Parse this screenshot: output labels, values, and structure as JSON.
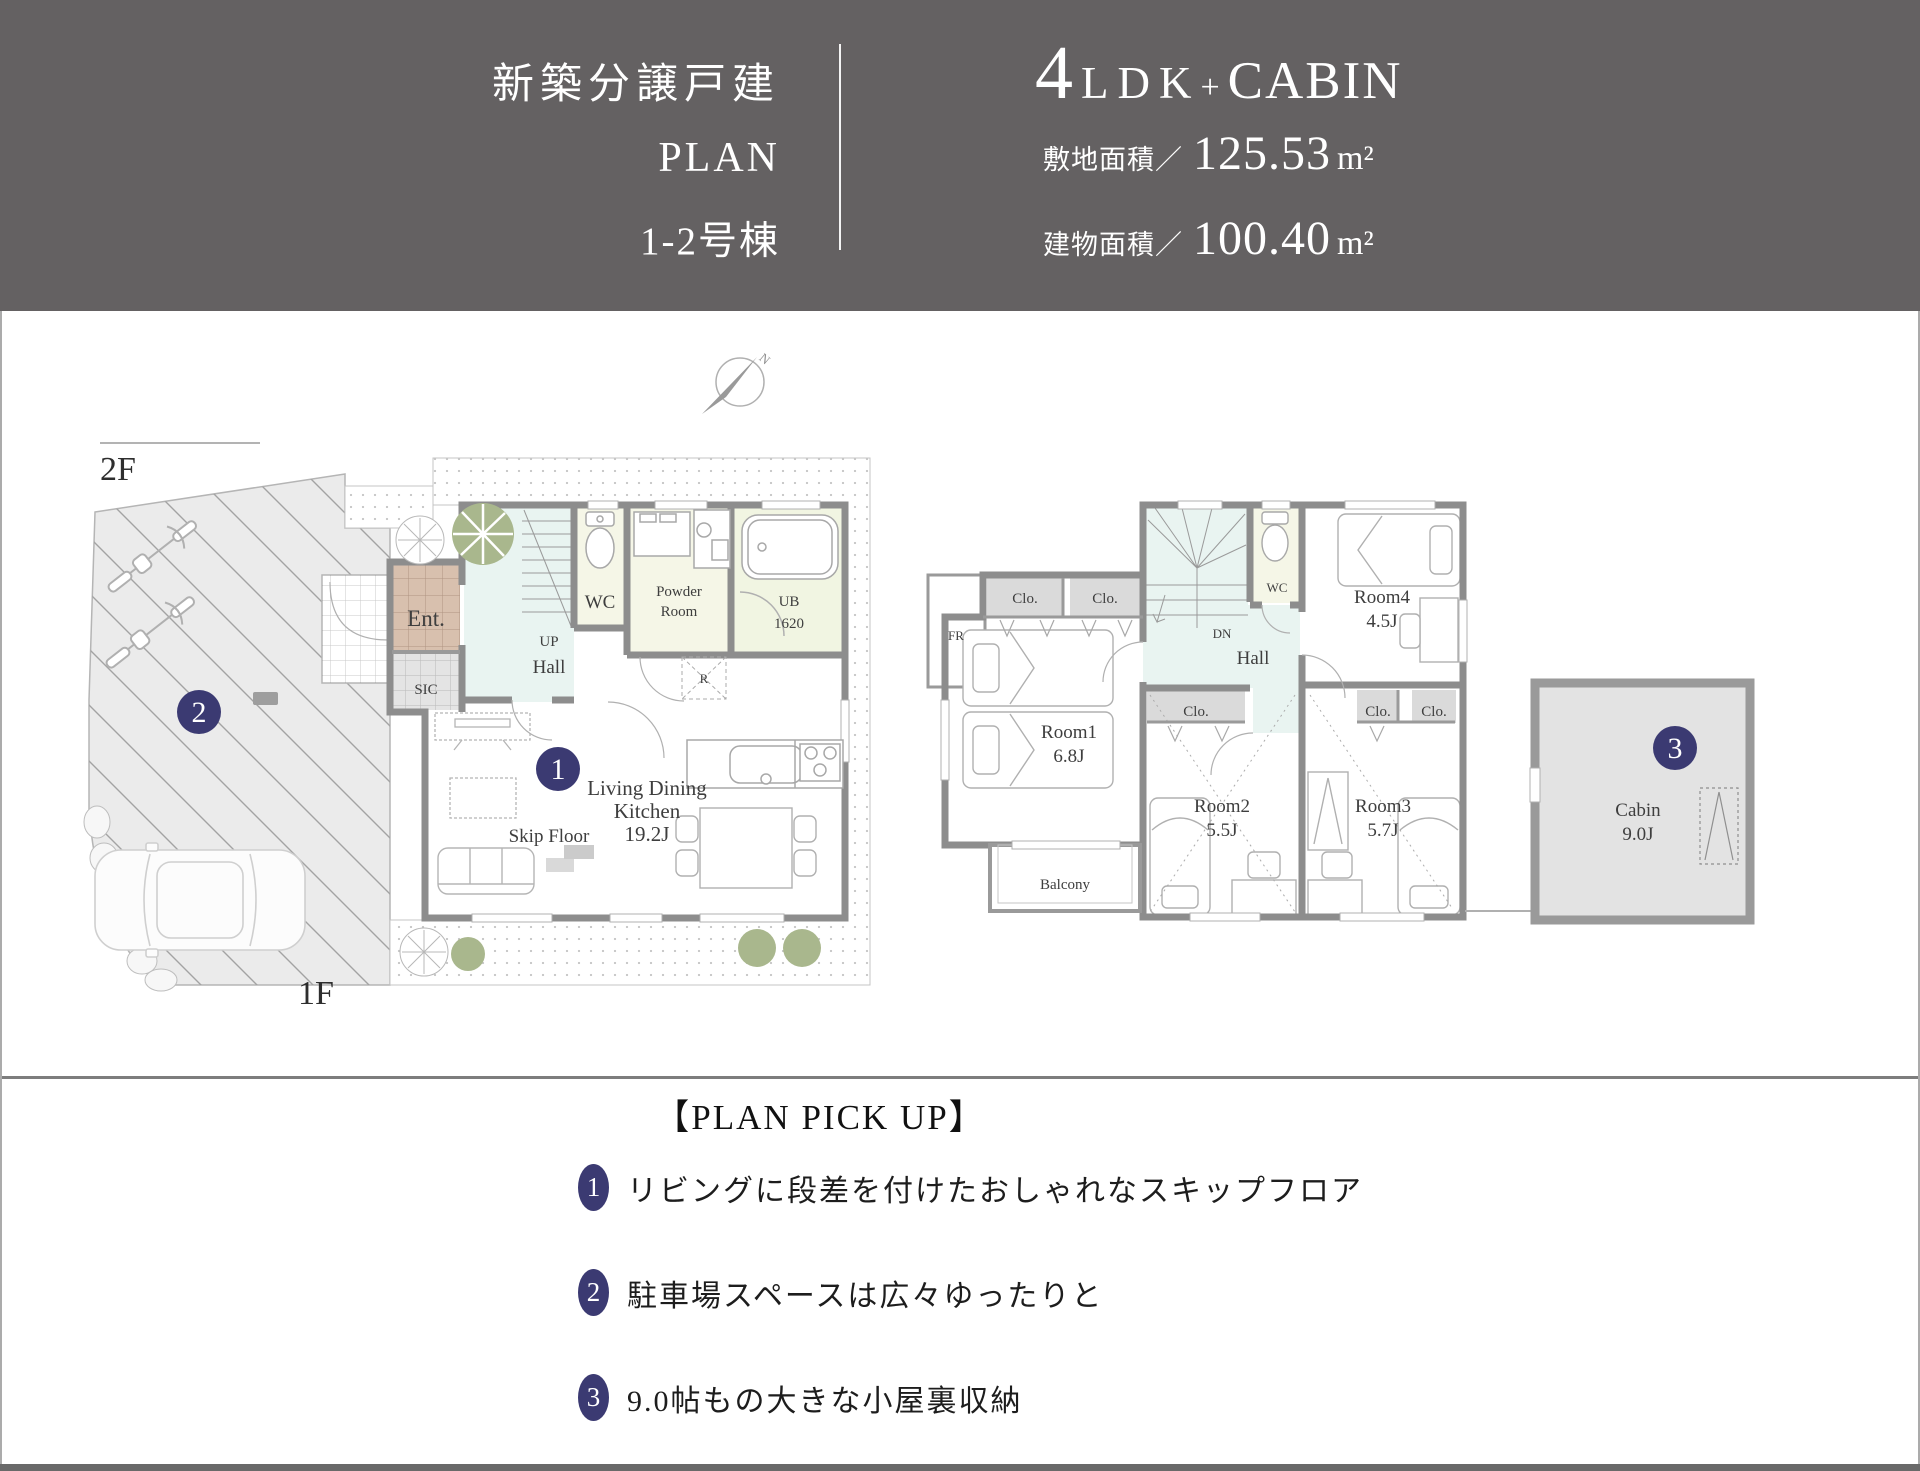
{
  "header": {
    "line1": "新築分譲戸建",
    "line2": "PLAN",
    "line3": "1-2号棟",
    "layout": {
      "num": "4",
      "ldk": "LDK",
      "plus": "+",
      "cabin": "CABIN"
    },
    "land": {
      "label": "敷地面積／",
      "value": "125.53",
      "unit": "m²"
    },
    "bldg": {
      "label": "建物面積／",
      "value": "100.40",
      "unit": "m²"
    }
  },
  "plan": {
    "f2": "2F",
    "f1": "1F",
    "north": "N",
    "b1": "1",
    "b2": "2",
    "b3": "3",
    "ent": "Ent.",
    "sic": "SIC",
    "hall1": "Hall",
    "up": "UP",
    "wc1": "WC",
    "powder1": "Powder",
    "powder2": "Room",
    "ub1": "UB",
    "ub2": "1620",
    "r": "R",
    "ldk1": "Living Dining",
    "ldk2": "Kitchen",
    "ldk3": "19.2J",
    "skip": "Skip Floor",
    "fr": "FR",
    "clo": "Clo.",
    "dn": "DN",
    "hall2": "Hall",
    "wc2": "WC",
    "room1": "Room1",
    "room1s": "6.8J",
    "room2": "Room2",
    "room2s": "5.5J",
    "room3": "Room3",
    "room3s": "5.7J",
    "room4": "Room4",
    "room4s": "4.5J",
    "balcony": "Balcony",
    "cabin": "Cabin",
    "cabins": "9.0J"
  },
  "pickup": {
    "heading": "【PLAN PICK UP】",
    "items": [
      {
        "num": "1",
        "text": "リビングに段差を付けたおしゃれなスキップフロア"
      },
      {
        "num": "2",
        "text": "駐車場スペースは広々ゆったりと"
      },
      {
        "num": "3",
        "text": "9.0帖もの大きな小屋裏収納"
      }
    ]
  },
  "colors": {
    "header_bg": "#646162",
    "badge": "#3b3a72",
    "wall": "#8d8d8d",
    "hall_fill": "#e9f4f1",
    "wet_fill": "#f5f6e7",
    "ub_fill": "#f1f5e2",
    "ent_tile": "#d8c0ae",
    "clo_fill": "#dadada",
    "cabin_fill": "#e3e3e3",
    "tree_green": "#a9b78d"
  }
}
